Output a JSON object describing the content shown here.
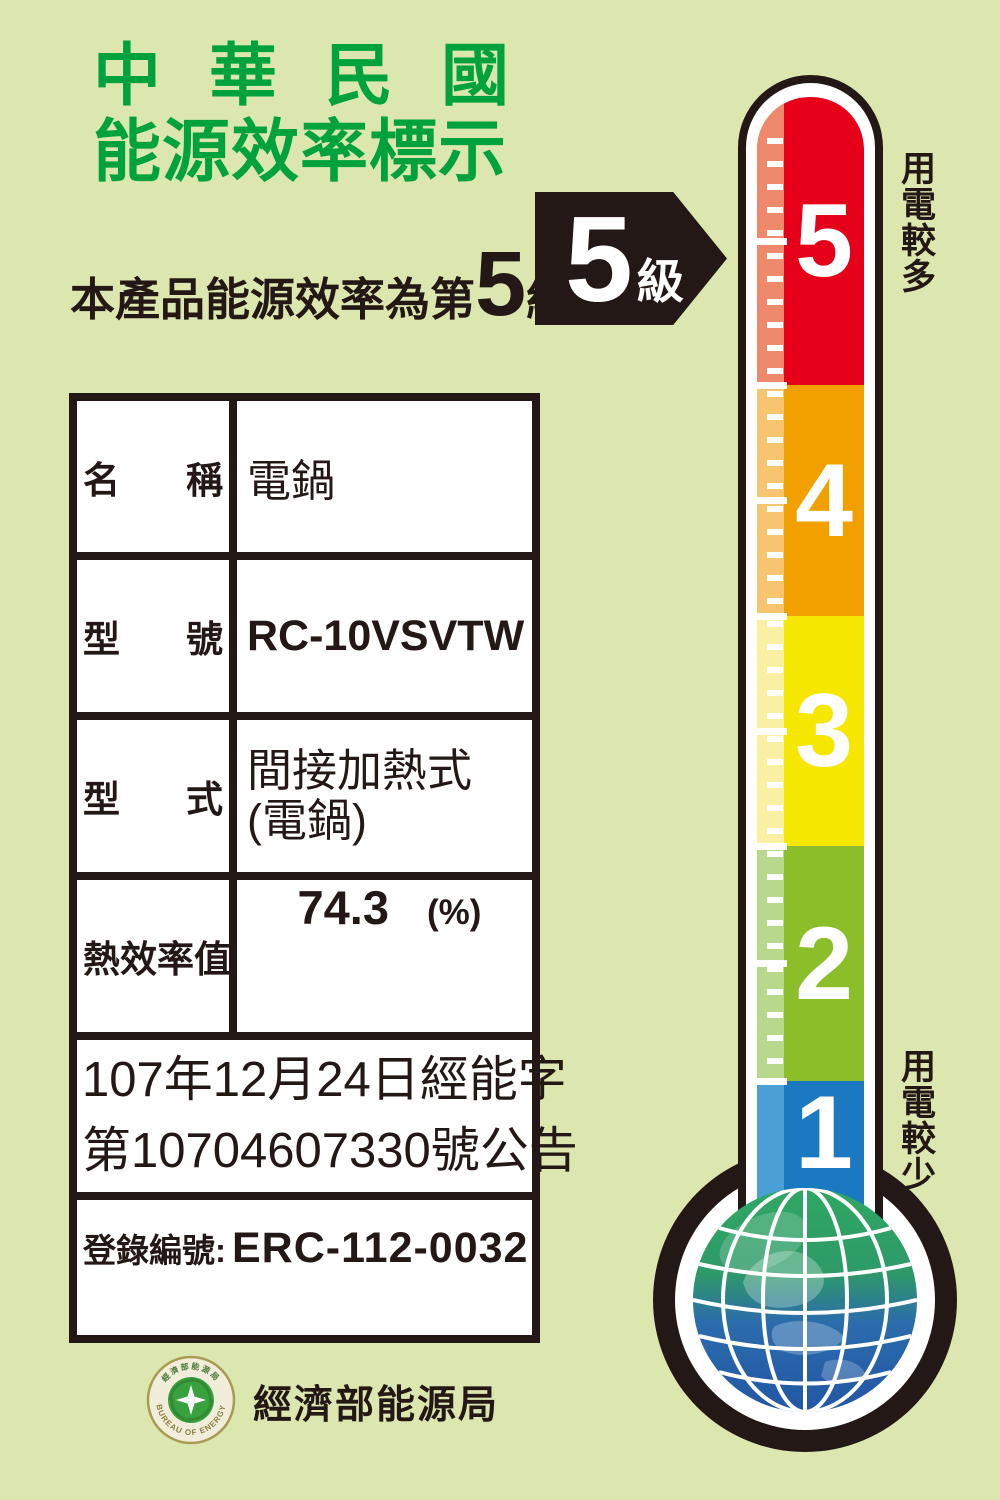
{
  "header": {
    "title_line1": "中華民國",
    "title_line2": "能源效率標示"
  },
  "rating": {
    "prefix": "本產品能源效率為第",
    "level": "5",
    "suffix": "級"
  },
  "arrow": {
    "level": "5",
    "unit": "級"
  },
  "thermometer": {
    "top_label": "用電較多",
    "bottom_label": "用電較少",
    "levels": [
      {
        "num": "5",
        "color": "#e60019",
        "light_color": "#ee8a6b",
        "height_px": 288
      },
      {
        "num": "4",
        "color": "#f2a000",
        "light_color": "#f7c470",
        "height_px": 231
      },
      {
        "num": "3",
        "color": "#f5e700",
        "light_color": "#f9f0a2",
        "height_px": 230
      },
      {
        "num": "2",
        "color": "#8bbf2a",
        "light_color": "#b8d98c",
        "height_px": 235
      },
      {
        "num": "1",
        "color": "#1b79c2",
        "light_color": "#4a9fd4",
        "height_px": 162
      }
    ]
  },
  "table": {
    "rows": [
      {
        "label": "名 稱",
        "value": "電鍋"
      },
      {
        "label": "型 號",
        "value": "RC-10VSVTW"
      },
      {
        "label": "型 式",
        "value_line1": "間接加熱式",
        "value_line2": "(電鍋)"
      },
      {
        "label": "熱效率值",
        "value": "74.3",
        "unit": "(%)"
      }
    ],
    "notice_line1": "107年12月24日經能字",
    "notice_line2": "第10704607330號公告",
    "registration_label": "登錄編號:",
    "registration_value": "ERC-112-0032"
  },
  "footer": {
    "agency": "經濟部能源局",
    "seal_top_text": "經濟部能源局",
    "seal_bottom_text": "BUREAU OF ENERGY"
  },
  "colors": {
    "background": "#dbe7af",
    "ink_black": "#231815",
    "title_green": "#00a23e",
    "level5_red": "#e60019",
    "level4_orange": "#f2a000",
    "level3_yellow": "#f5e700",
    "level2_green": "#8bbf2a",
    "level1_blue": "#1b79c2",
    "globe_green": "#2fa763",
    "globe_blue": "#2256a4",
    "seal_gold": "#a79b52",
    "seal_green": "#3aa23d"
  }
}
